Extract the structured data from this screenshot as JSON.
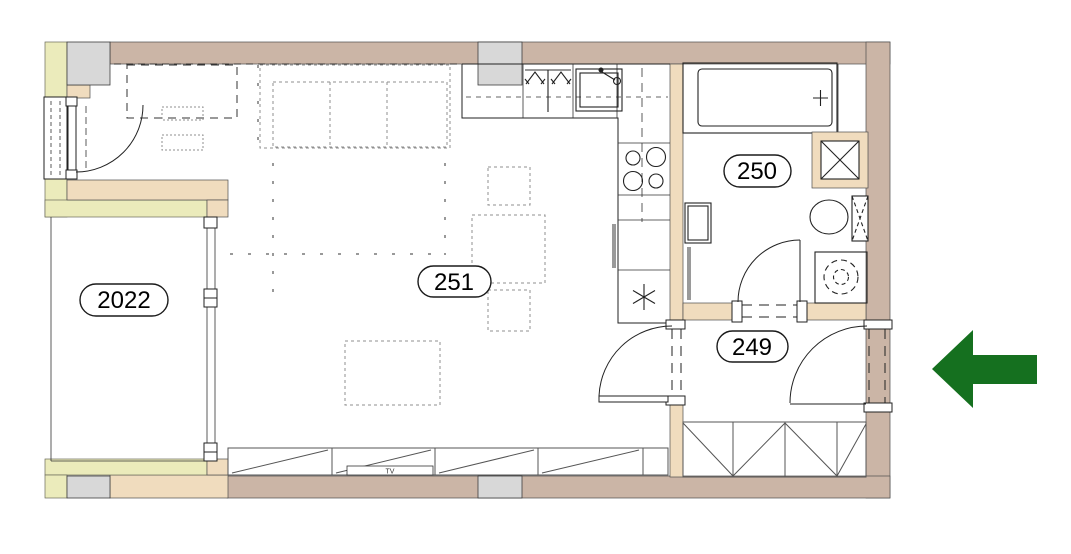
{
  "plan": {
    "title": "apartment-floor-plan",
    "rooms": [
      {
        "label": "2022",
        "type": "balcony"
      },
      {
        "label": "251",
        "type": "living-room-with-kitchen"
      },
      {
        "label": "250",
        "type": "bathroom"
      },
      {
        "label": "249",
        "type": "entrance-hall"
      }
    ],
    "tv_label": "TV",
    "entrance_arrow": {
      "direction": "left",
      "color": "#15701f"
    },
    "colors": {
      "exterior_wall": "#cbb5a6",
      "partition_wall": "#f0dcbe",
      "adjacent_wall": "#ebebbb",
      "column": "#d8d8d8",
      "furniture_dash": "#8f8f8f"
    },
    "fixture_icons": [
      "bathtub-icon",
      "toilet-icon",
      "washbasin-icon",
      "washing-machine-icon",
      "ventilation-shaft-icon",
      "kitchen-sink-icon",
      "stove-icon",
      "fridge-icon",
      "dish-rack-icon",
      "wardrobe-icon",
      "sideboard-icon",
      "tv-icon",
      "dining-table-icon",
      "chair-icon",
      "radiator-icon",
      "door-swing-icon"
    ]
  }
}
